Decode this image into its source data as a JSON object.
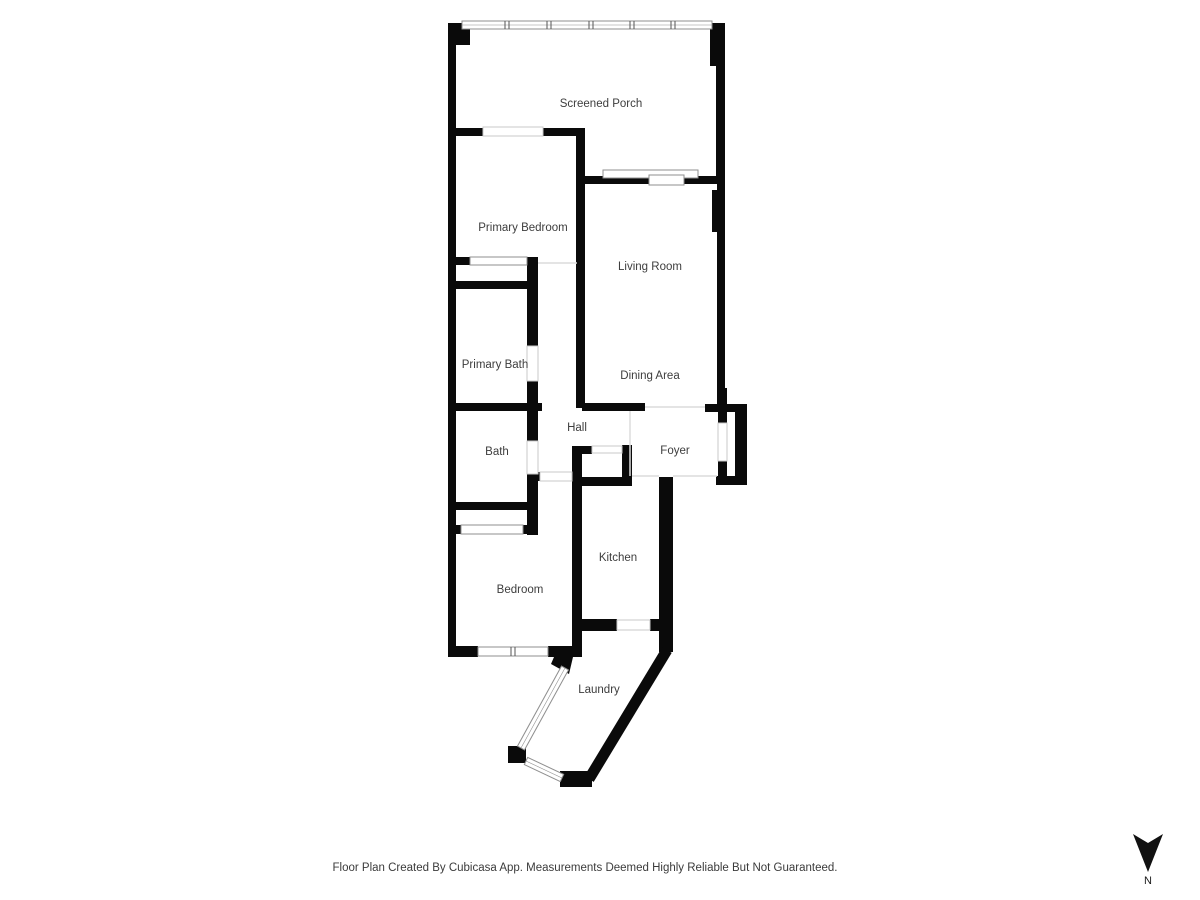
{
  "page": {
    "background": "#ffffff"
  },
  "floor_plan": {
    "rooms": [
      {
        "id": "screened-porch",
        "name": "Screened Porch"
      },
      {
        "id": "primary-bedroom",
        "name": "Primary Bedroom"
      },
      {
        "id": "living-room",
        "name": "Living Room"
      },
      {
        "id": "primary-bath",
        "name": "Primary Bath"
      },
      {
        "id": "dining-area",
        "name": "Dining Area"
      },
      {
        "id": "hall",
        "name": "Hall"
      },
      {
        "id": "bath",
        "name": "Bath"
      },
      {
        "id": "foyer",
        "name": "Foyer"
      },
      {
        "id": "kitchen",
        "name": "Kitchen"
      },
      {
        "id": "bedroom",
        "name": "Bedroom"
      },
      {
        "id": "laundry",
        "name": "Laundry"
      }
    ],
    "colors": {
      "wall": "#0a0a0a",
      "window_outline": "#8f8f8f",
      "window_fill": "#ffffff",
      "opening_outline": "#c9c9c9",
      "boundary_line": "#dcdcdc",
      "label_text": "#3d3d3d",
      "mullion": "#555555"
    }
  },
  "compass": {
    "label": "N"
  },
  "footer": {
    "disclaimer": "Floor Plan Created By Cubicasa App. Measurements Deemed Highly Reliable But Not Guaranteed."
  }
}
